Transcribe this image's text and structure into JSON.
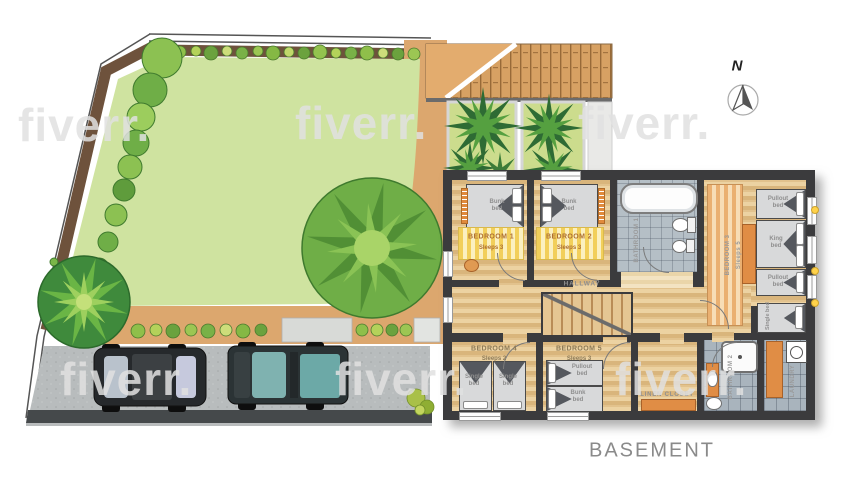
{
  "title": "BASEMENT",
  "compass": {
    "label": "N"
  },
  "watermark": {
    "text": "fiverr."
  },
  "plan": {
    "bedroom1": {
      "name": "BEDROOM 1",
      "sleeps": "Sleeps 3",
      "beds": {
        "bunk": "Bunk bed"
      }
    },
    "bedroom2": {
      "name": "BEDROOM 2",
      "sleeps": "Sleeps 3",
      "beds": {
        "bunk": "Bunk bed"
      }
    },
    "bedroom3": {
      "name": "BEDROOM 3",
      "sleeps": "Sleeps 5",
      "beds": {
        "pullout_top": "Pullout bed",
        "king": "King bed",
        "pullout_bottom": "Pullout bed",
        "single": "Single bed"
      }
    },
    "bedroom4": {
      "name": "BEDROOM 4",
      "sleeps": "Sleeps 2",
      "beds": {
        "single_left": "Single bed",
        "single_right": "Single bed"
      }
    },
    "bedroom5": {
      "name": "BEDROOM 5",
      "sleeps": "Sleeps 3",
      "beds": {
        "pullout": "Pullout bed",
        "bunk": "Bunk bed"
      }
    },
    "hallway": {
      "name": "HALLWAY"
    },
    "linen_closet": {
      "name": "LINEN CLOSET"
    },
    "bathroom1": {
      "name": "BATHROOM 1"
    },
    "bathroom2": {
      "name": "BATHROOM 2"
    },
    "laundry": {
      "name": "LAUNDRY"
    }
  },
  "colors": {
    "wall": "#3b3b3d",
    "wood": "#e2c28d",
    "tile": "#b5bfc6",
    "lawn": "#cfe3a0",
    "path": "#dca76e",
    "accent": "#e08d45",
    "rug_yellow": "#f2cf5a",
    "tree_dark": "#4c8a33",
    "tree_light": "#8ac355",
    "driveway": "#b8bcbd"
  }
}
